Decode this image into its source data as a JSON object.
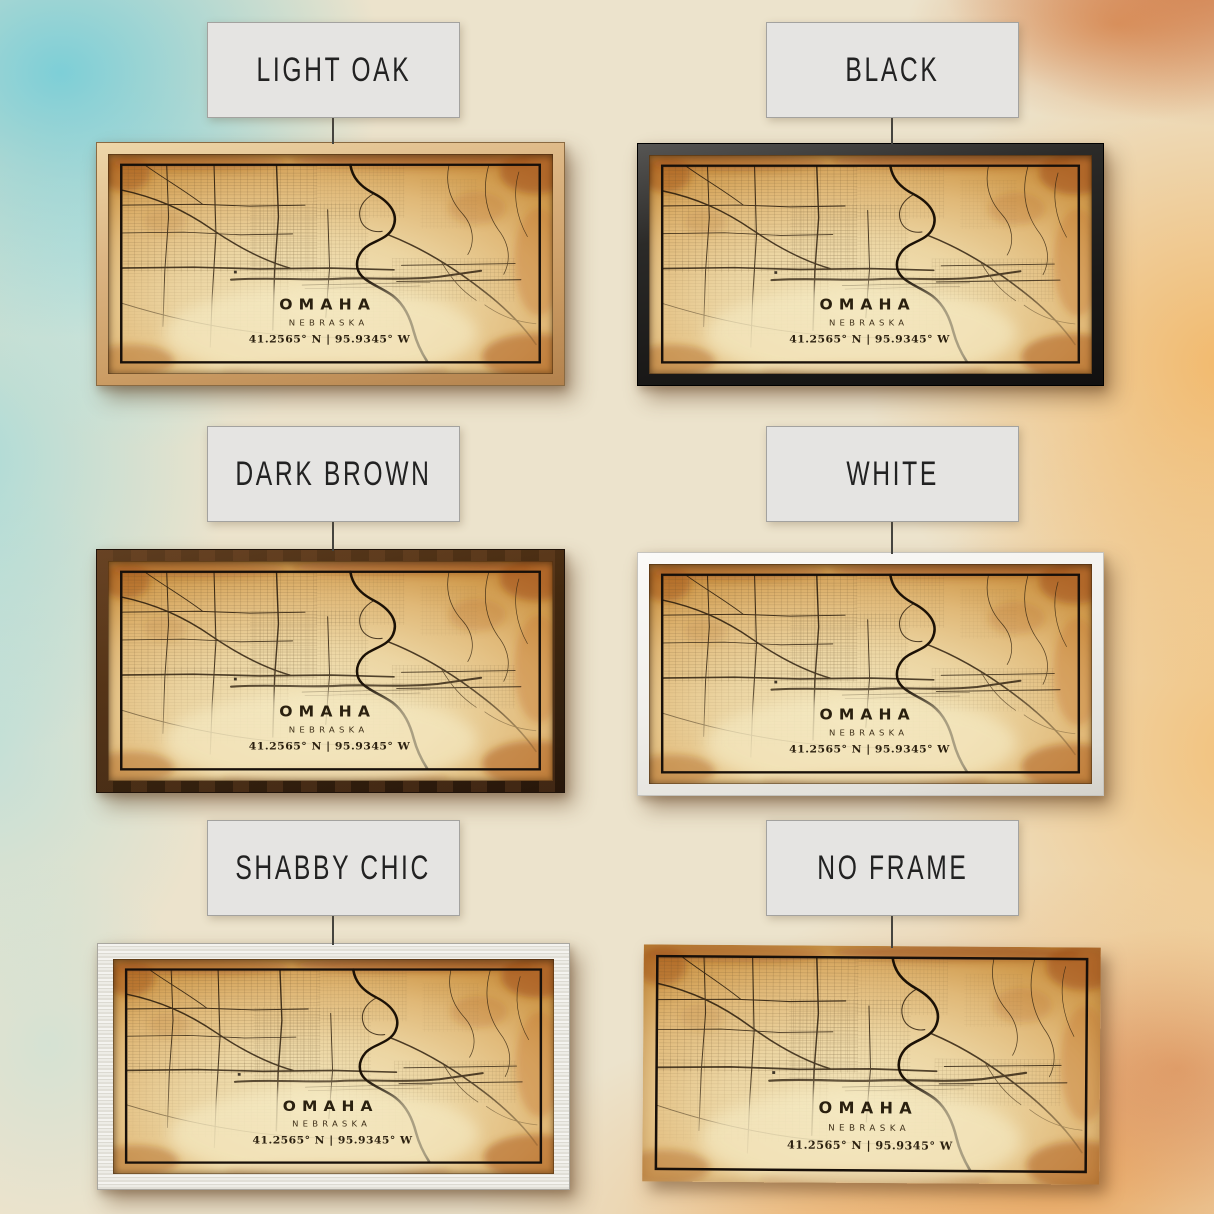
{
  "options": [
    {
      "id": "light-oak",
      "label": "LIGHT OAK"
    },
    {
      "id": "black",
      "label": "BLACK"
    },
    {
      "id": "dark-brown",
      "label": "DARK BROWN"
    },
    {
      "id": "white",
      "label": "WHITE"
    },
    {
      "id": "shabby-chic",
      "label": "SHABBY CHIC"
    },
    {
      "id": "no-frame",
      "label": "NO FRAME"
    }
  ],
  "print": {
    "city": "OMAHA",
    "state": "NEBRASKA",
    "coordinates": "41.2565° N | 95.9345° W"
  },
  "colors": {
    "light_oak_frame": "#cb9c64",
    "black_frame": "#191817",
    "dark_brown_frame": "#44290f",
    "white_frame": "#f1f0ec",
    "shabby_chic_frame": "#edece6",
    "paper_center": "#f3e6bd",
    "paper_edge": "#c4883c",
    "map_ink": "#2a1c0c",
    "background_teal": "#6acbd9",
    "background_orange": "#f3b25c",
    "label_card_fill": "#e5e4e2"
  }
}
